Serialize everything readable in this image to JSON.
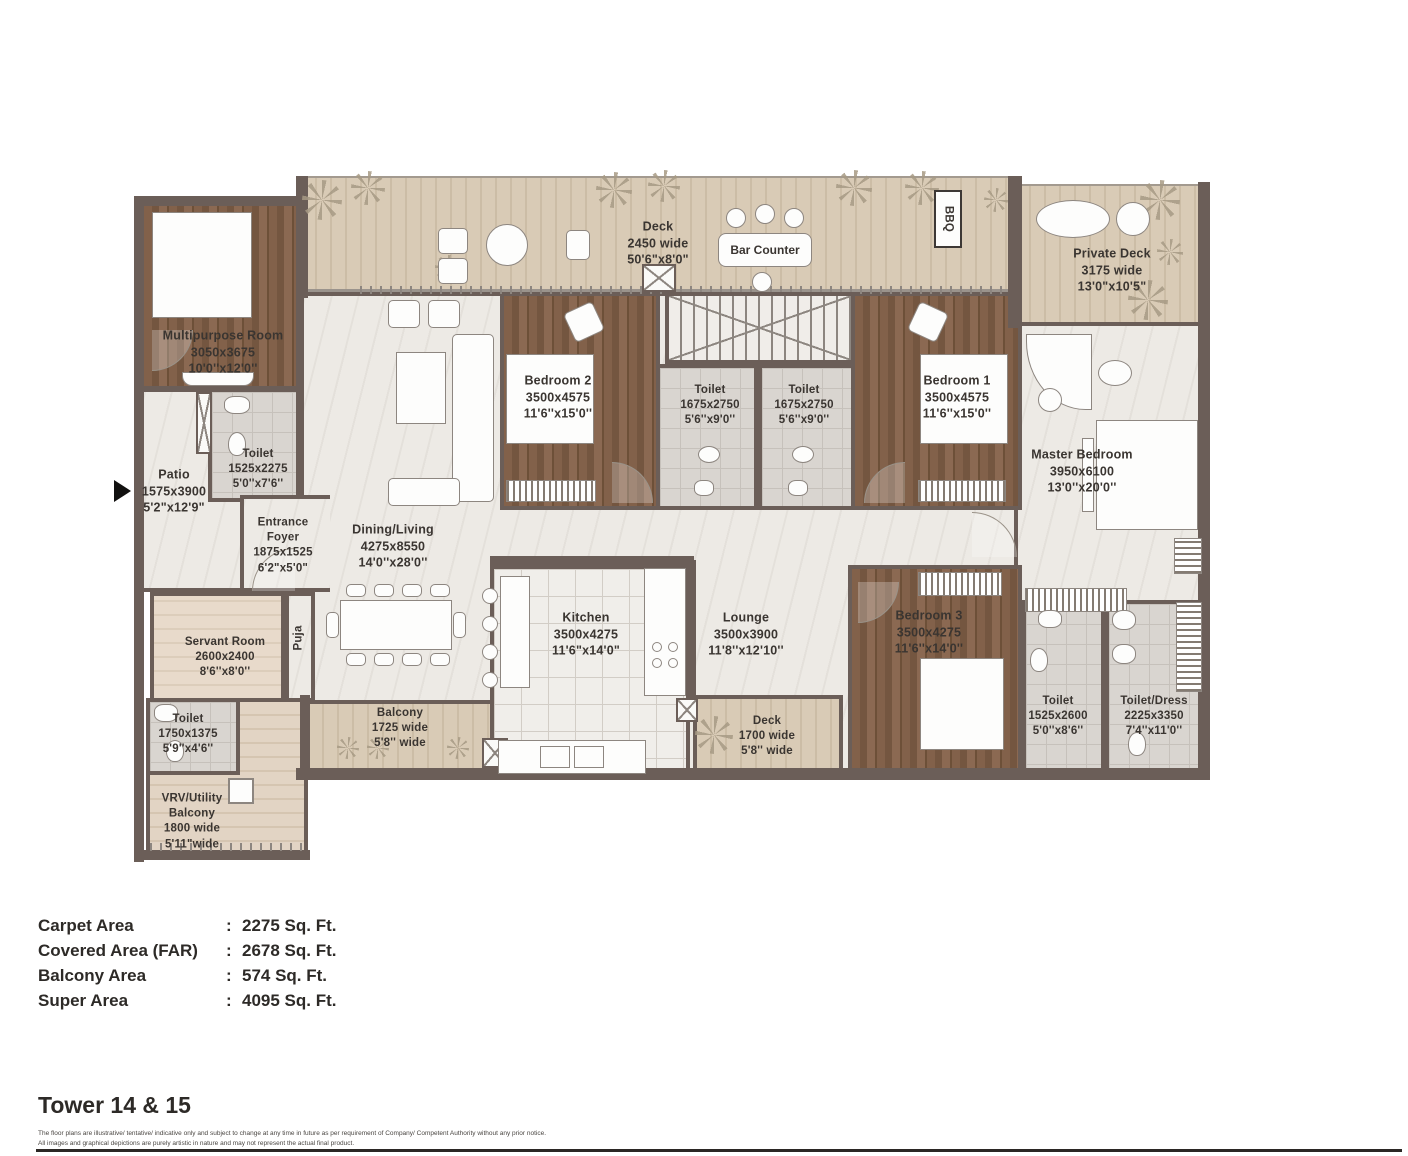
{
  "colors": {
    "wall": "#6b5e58",
    "marble_floor": "#edeae5",
    "deck_wood": "#d8cab5",
    "bedroom_wood": "#7d5d46",
    "tile": "#d9d5d0",
    "label_text": "#3a3531"
  },
  "rooms": {
    "deck_top": [
      "Deck",
      "2450 wide",
      "50'6\"x8'0\""
    ],
    "bar_counter": [
      "Bar Counter"
    ],
    "bbq": [
      "BBQ"
    ],
    "private_deck": [
      "Private Deck",
      "3175 wide",
      "13'0\"x10'5\""
    ],
    "multipurpose": [
      "Multipurpose Room",
      "3050x3675",
      "10'0''x12'0''"
    ],
    "toilet_multipurpose": [
      "Toilet",
      "1525x2275",
      "5'0''x7'6''"
    ],
    "patio": [
      "Patio",
      "1575x3900",
      "5'2\"x12'9\""
    ],
    "entrance_foyer": [
      "Entrance",
      "Foyer",
      "1875x1525",
      "6'2\"x5'0\""
    ],
    "dining_living": [
      "Dining/Living",
      "4275x8550",
      "14'0''x28'0''"
    ],
    "bedroom2": [
      "Bedroom 2",
      "3500x4575",
      "11'6''x15'0''"
    ],
    "toilet_center_1": [
      "Toilet",
      "1675x2750",
      "5'6''x9'0''"
    ],
    "toilet_center_2": [
      "Toilet",
      "1675x2750",
      "5'6''x9'0''"
    ],
    "bedroom1": [
      "Bedroom 1",
      "3500x4575",
      "11'6''x15'0''"
    ],
    "master_bedroom": [
      "Master Bedroom",
      "3950x6100",
      "13'0''x20'0''"
    ],
    "servant_room": [
      "Servant Room",
      "2600x2400",
      "8'6''x8'0''"
    ],
    "puja": [
      "Puja"
    ],
    "kitchen": [
      "Kitchen",
      "3500x4275",
      "11'6\"x14'0\""
    ],
    "lounge": [
      "Lounge",
      "3500x3900",
      "11'8''x12'10''"
    ],
    "bedroom3": [
      "Bedroom 3",
      "3500x4275",
      "11'6''x14'0''"
    ],
    "balcony": [
      "Balcony",
      "1725 wide",
      "5'8'' wide"
    ],
    "deck_small": [
      "Deck",
      "1700 wide",
      "5'8'' wide"
    ],
    "toilet_servant": [
      "Toilet",
      "1750x1375",
      "5'9''x4'6''"
    ],
    "vrv_utility": [
      "VRV/Utility",
      "Balcony",
      "1800 wide",
      "5'11\"wide"
    ],
    "toilet_bedroom3": [
      "Toilet",
      "1525x2600",
      "5'0''x8'6''"
    ],
    "toilet_dress": [
      "Toilet/Dress",
      "2225x3350",
      "7'4''x11'0''"
    ]
  },
  "areas": {
    "colon": ":",
    "rows": [
      {
        "label": "Carpet Area",
        "value": "2275 Sq. Ft."
      },
      {
        "label": "Covered Area (FAR)",
        "value": "2678 Sq. Ft."
      },
      {
        "label": "Balcony Area",
        "value": "574 Sq. Ft."
      },
      {
        "label": "Super Area",
        "value": "4095 Sq. Ft."
      }
    ]
  },
  "footer": {
    "title": "Tower 14 & 15",
    "disclaimer_line1": "The floor plans are illustrative/ tentative/ indicative only and subject to change at any time in future as per requirement of Company/ Competent Authority without any prior notice.",
    "disclaimer_line2": "All images and graphical depictions are purely artistic in nature and may not represent the actual final product."
  }
}
